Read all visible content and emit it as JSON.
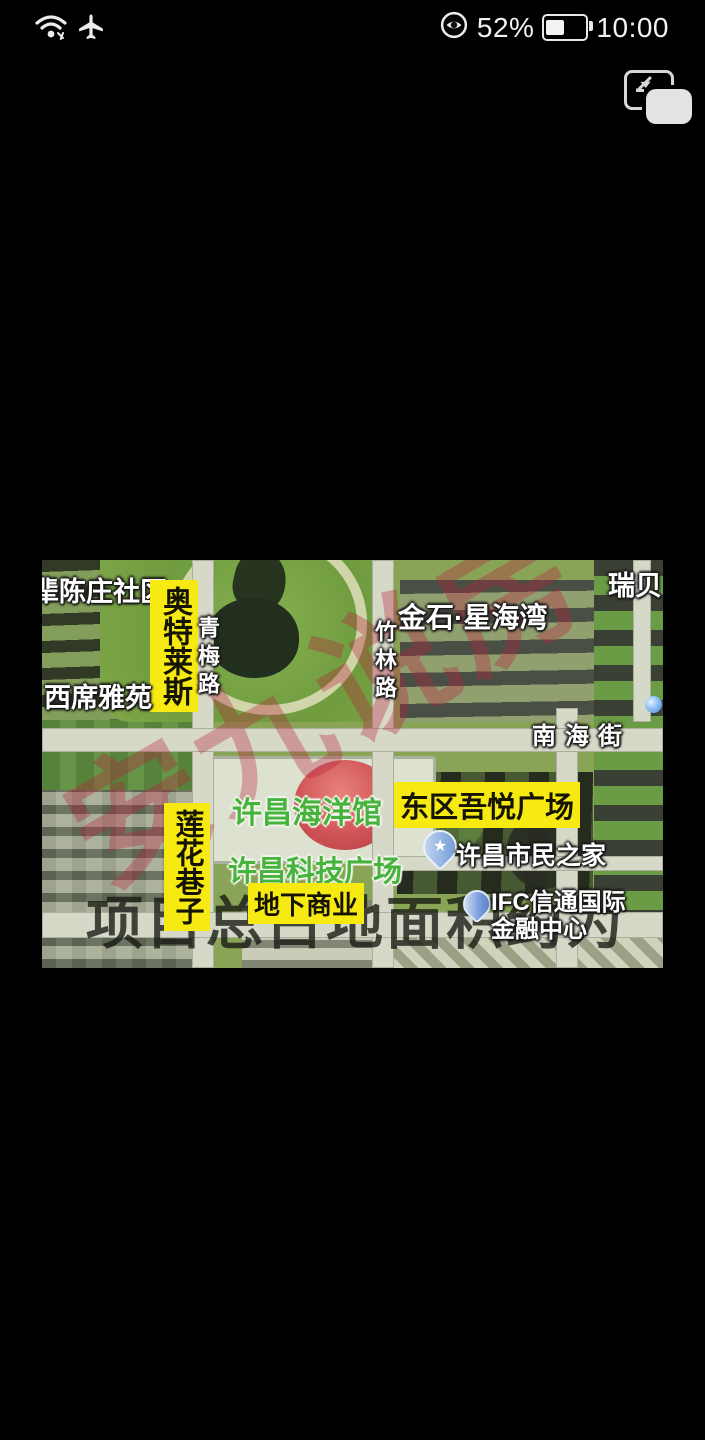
{
  "status_bar": {
    "time": "10:00",
    "battery_percent": "52%",
    "icons": [
      "wifi-icon",
      "airplane-mode-icon",
      "eye-comfort-icon",
      "battery-icon"
    ]
  },
  "floating_button": {
    "name": "screenshot-thumbnail"
  },
  "map": {
    "labels": {
      "community_top_left": "辈陈庄社区",
      "outlets": "奥特莱斯",
      "road_qingmei": "青梅路",
      "xixi_yayuan": "西席雅苑",
      "jinshi_xinghaiwan": "金石·星海湾",
      "road_zhulin": "竹林路",
      "ruibei": "瑞贝",
      "road_nanhai": "南海街",
      "ocean_hall": "许昌海洋馆",
      "wuyue_plaza": "东区吾悦广场",
      "lianhua_lane": "莲花巷子",
      "tech_plaza": "许昌科技广场",
      "citizen_home": "许昌市民之家",
      "underground_business": "地下商业",
      "ifc_line1": "IFC信通国际",
      "ifc_line2": "金融中心"
    },
    "pins": {
      "star": "★"
    },
    "watermarks": {
      "red_diagonal": "安九说房",
      "dark_overlay": "项目总占地面积约为"
    },
    "colors": {
      "label_highlight": "#f7ea12",
      "label_green": "#46b33c",
      "watermark_red": "rgba(186,32,62,0.34)"
    }
  }
}
